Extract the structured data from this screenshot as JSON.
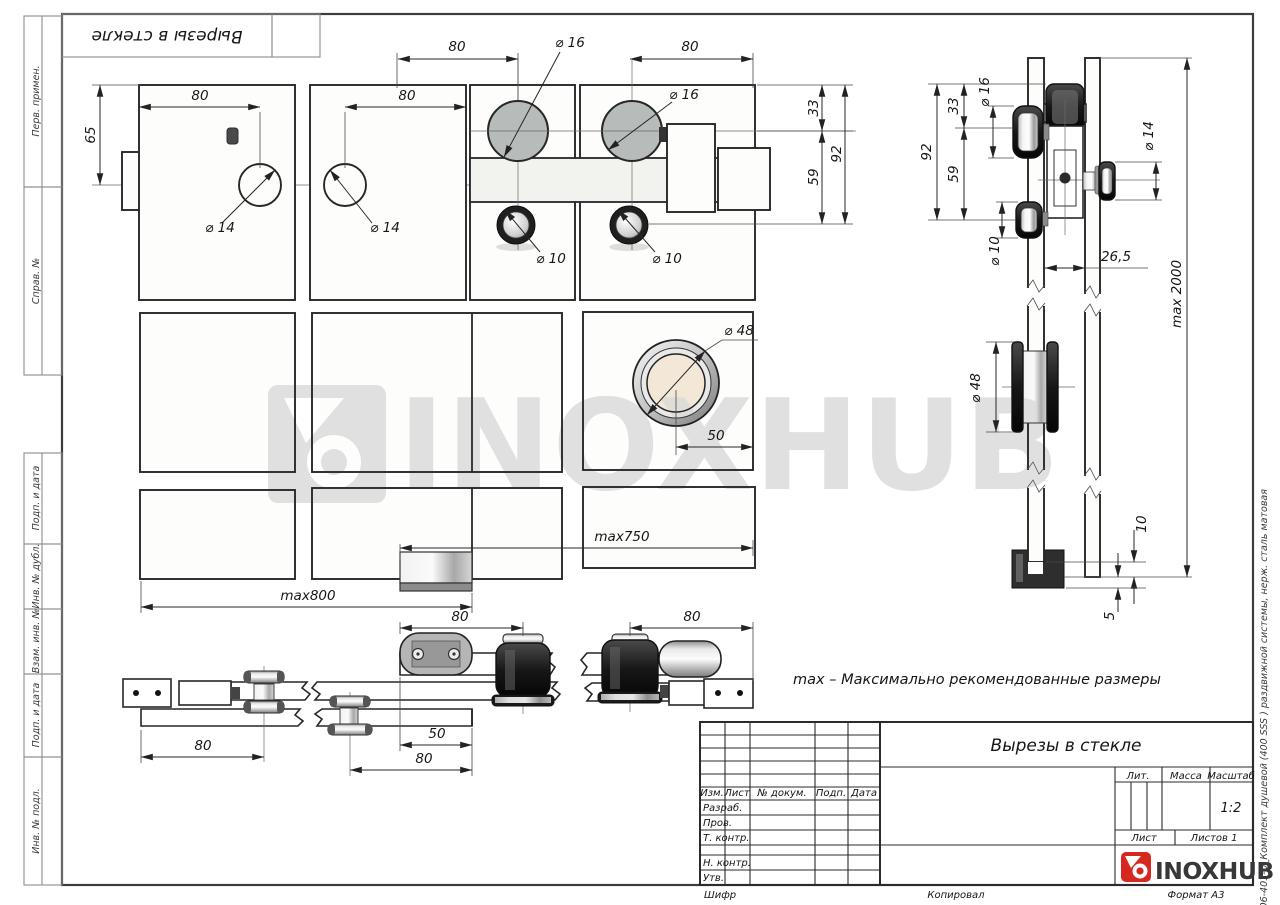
{
  "drawing": {
    "stamp_title": "Вырезы в стекле",
    "note": "max – Максимально рекомендованные размеры",
    "watermark": "INOXHUB"
  },
  "left_margin": {
    "labels": [
      "Перв. примен.",
      "Справ. №",
      "Подп. и дата",
      "Инв. № дубл.",
      "Взам. инв. №",
      "Подп. и дата",
      "Инв. № подл."
    ]
  },
  "right_margin": {
    "file_note": "Файл: 806-401-U_Комплект душевой (400 SSS ) раздвижной системы, нерж. сталь матовая"
  },
  "dims": {
    "d65": "65",
    "d80": "80",
    "d33": "33",
    "d59": "59",
    "d92": "92",
    "d14": "⌀ 14",
    "d16": "⌀ 16",
    "d10": "⌀ 10",
    "d48": "⌀ 48",
    "d50": "50",
    "d26_5": "26,5",
    "max2000": "max 2000",
    "max750": "max750",
    "max800": "max800",
    "d10_gap": "10",
    "d5": "5"
  },
  "title_block": {
    "title": "Вырезы в стекле",
    "col_izm": "Изм.",
    "col_list": "Лист",
    "col_docnum": "№ докум.",
    "col_podp": "Подп.",
    "col_data": "Дата",
    "row_razrab": "Разраб.",
    "row_prov": "Пров.",
    "row_tkontr": "Т. контр.",
    "row_nkontr": "Н. контр.",
    "row_utv": "Утв.",
    "lit": "Лит.",
    "massa": "Масса",
    "masshtab": "Масштаб",
    "masshtab_value": "1:2",
    "list": "Лист",
    "listov": "Листов 1",
    "shifr": "Шифр",
    "kopiroval": "Копировал",
    "format": "Формат А3",
    "logo": "INOXHUB",
    "logo_color": "#d7281f"
  }
}
